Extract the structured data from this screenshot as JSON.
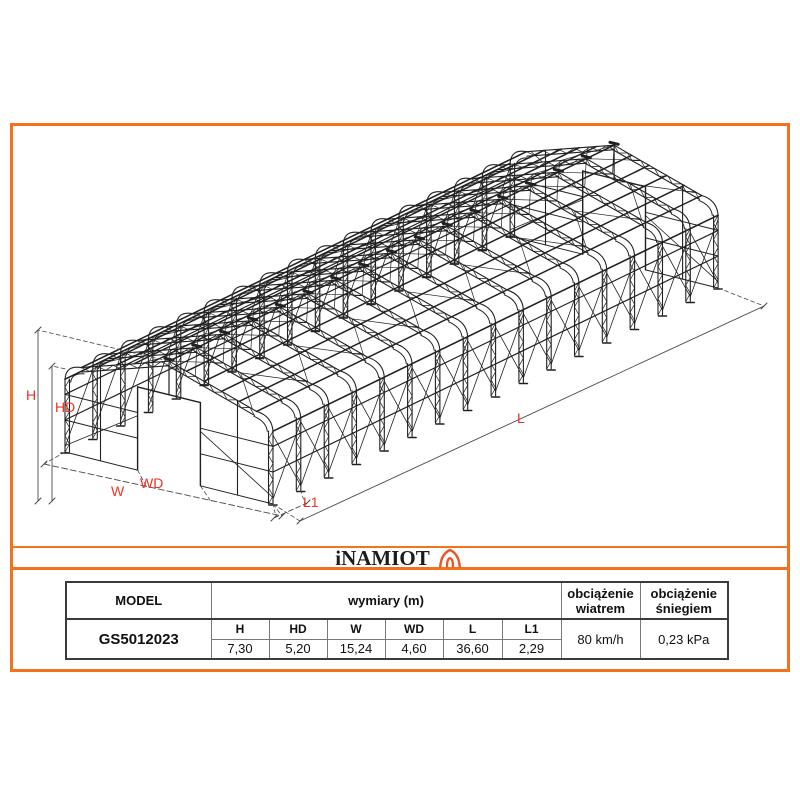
{
  "colors": {
    "accent_orange": "#f4711f",
    "label_red": "#ee3124",
    "structure_ink": "#212121"
  },
  "logo": {
    "text": "iNAMIOT",
    "icon": "tent-icon"
  },
  "drawing": {
    "labels": {
      "h": "H",
      "hd": "HD",
      "w": "W",
      "wd": "WD",
      "l": "L",
      "l1": "L1"
    }
  },
  "table": {
    "model_header": "MODEL",
    "dims_header": "wymiary (m)",
    "wind_header": "obciążenie wiatrem",
    "snow_header": "obciążenie śniegiem",
    "model": "GS5012023",
    "columns": [
      {
        "label": "H",
        "value": "7,30"
      },
      {
        "label": "HD",
        "value": "5,20"
      },
      {
        "label": "W",
        "value": "15,24"
      },
      {
        "label": "WD",
        "value": "4,60"
      },
      {
        "label": "L",
        "value": "36,60"
      },
      {
        "label": "L1",
        "value": "2,29"
      }
    ],
    "wind_value": "80 km/h",
    "snow_value": "0,23 kPa"
  }
}
